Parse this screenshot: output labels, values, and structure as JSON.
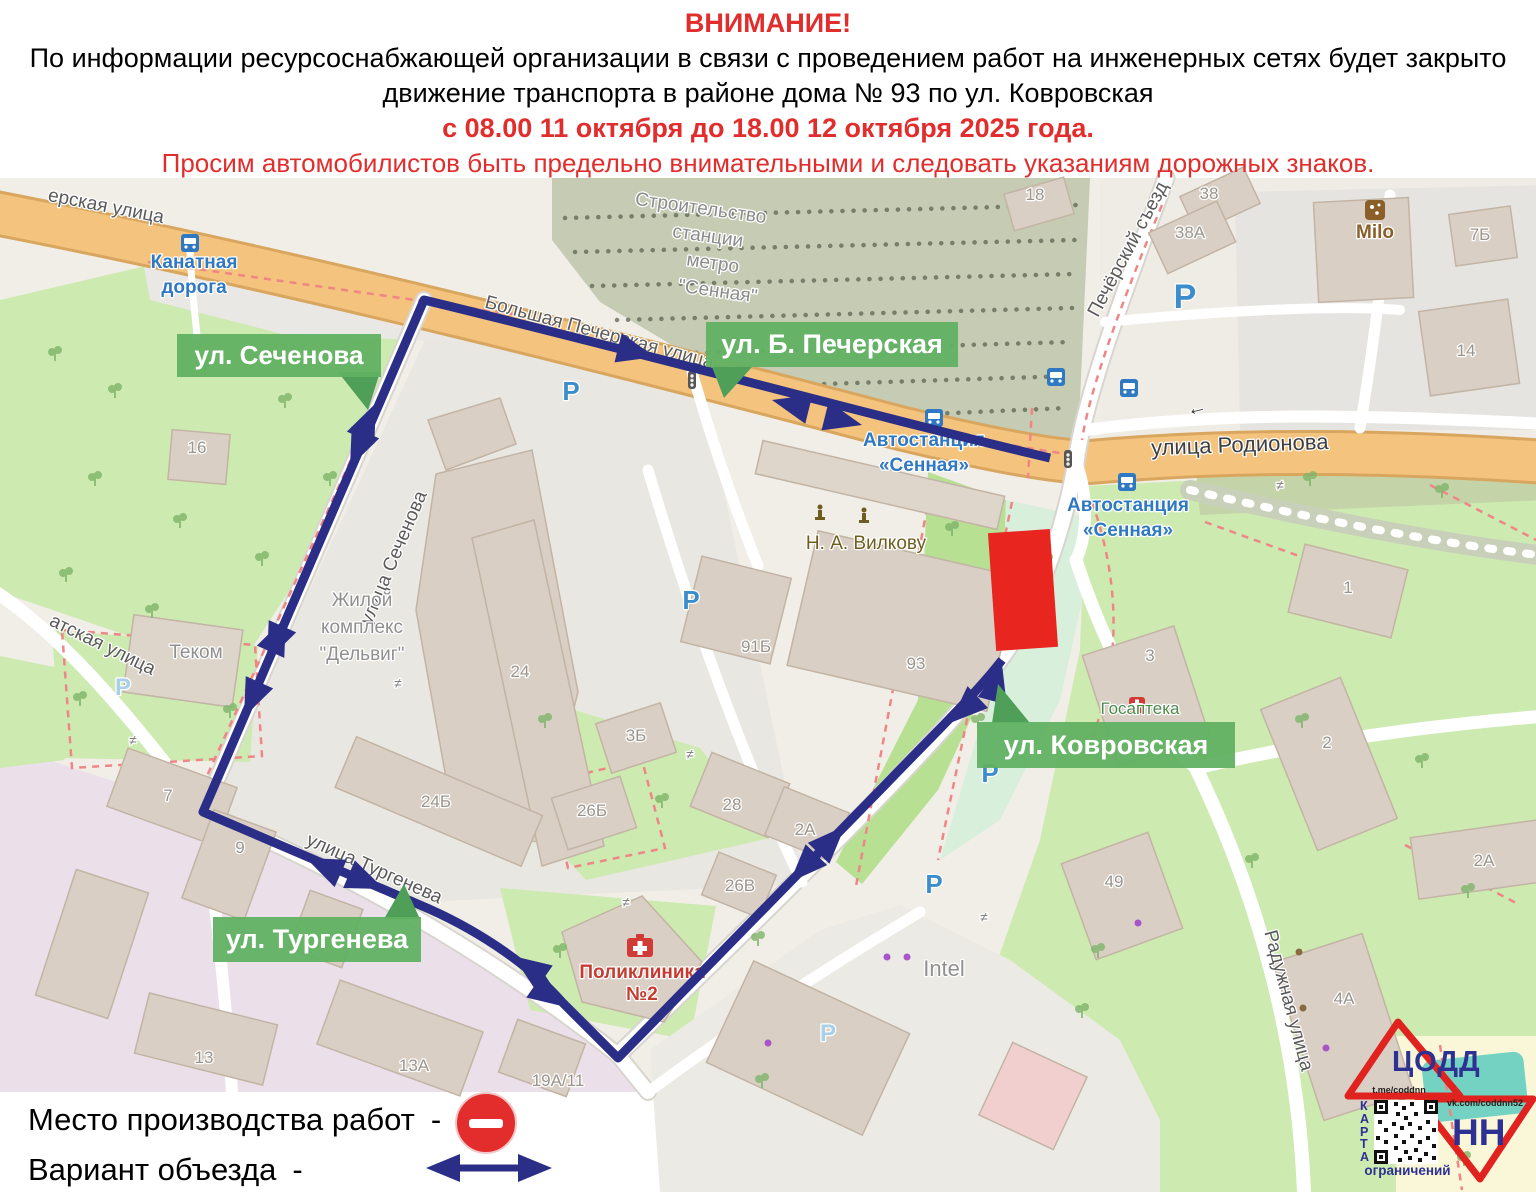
{
  "header": {
    "title": "ВНИМАНИЕ!",
    "line1": "По информации ресурсоснабжающей организации в связи с проведением работ на инженерных сетях будет закрыто",
    "line2": "движение транспорта в районе дома № 93 по ул. Ковровская",
    "dates": "с 08.00 11 октября до 18.00 12 октября 2025 года.",
    "warning": "Просим автомобилистов быть предельно внимательными и следовать указаниям дорожных знаков.",
    "accent_color": "#e22d2d"
  },
  "map": {
    "badges": [
      {
        "label": "ул. Сеченова"
      },
      {
        "label": "ул. Б. Печерская"
      },
      {
        "label": "ул. Ковровская"
      },
      {
        "label": "ул. Тургенева"
      }
    ],
    "badge_color": "#61b163",
    "route_color": "#2b2e87",
    "work_zone_color": "#e8251f",
    "parking_letter": "P",
    "parking": [
      {
        "x": 571,
        "y": 400
      },
      {
        "x": 691,
        "y": 609
      },
      {
        "x": 1185,
        "y": 308,
        "s": "big"
      },
      {
        "x": 990,
        "y": 782
      },
      {
        "x": 934,
        "y": 893
      },
      {
        "x": 828,
        "y": 1041,
        "s": "pale"
      },
      {
        "x": 123,
        "y": 695,
        "s": "pale"
      }
    ],
    "labels": [
      {
        "t": "ерская улица",
        "x": 105,
        "y": 212,
        "r": 11,
        "c": "st"
      },
      {
        "t": "Большая Печерская улица",
        "x": 598,
        "y": 338,
        "r": 15,
        "c": "st"
      },
      {
        "t": "улица Родионова",
        "x": 1240,
        "y": 452,
        "r": -2,
        "c": "stb"
      },
      {
        "t": "Печёрский съезд",
        "x": 1133,
        "y": 252,
        "r": -62,
        "c": "st"
      },
      {
        "t": "улица Сеченова",
        "x": 399,
        "y": 560,
        "r": -67,
        "c": "st"
      },
      {
        "t": "улица Тургенева",
        "x": 372,
        "y": 874,
        "r": 24,
        "c": "st"
      },
      {
        "t": "Радужная улица",
        "x": 1283,
        "y": 1002,
        "r": 75,
        "c": "st"
      },
      {
        "t": "атская улица",
        "x": 100,
        "y": 650,
        "r": 26,
        "c": "st"
      },
      {
        "t": "Канатная",
        "x": 194,
        "y": 268,
        "r": 0,
        "c": "bl"
      },
      {
        "t": "дорога",
        "x": 194,
        "y": 293,
        "r": 0,
        "c": "bl"
      },
      {
        "t": "Автостанция",
        "x": 924,
        "y": 446,
        "r": 0,
        "c": "bl"
      },
      {
        "t": "«Сенная»",
        "x": 924,
        "y": 471,
        "r": 0,
        "c": "bl"
      },
      {
        "t": "Автостанция",
        "x": 1128,
        "y": 511,
        "r": 0,
        "c": "bl"
      },
      {
        "t": "«Сенная»",
        "x": 1128,
        "y": 536,
        "r": 0,
        "c": "bl"
      },
      {
        "t": "Строительство",
        "x": 700,
        "y": 214,
        "r": 8,
        "c": "cn"
      },
      {
        "t": "станции",
        "x": 707,
        "y": 242,
        "r": 8,
        "c": "cn"
      },
      {
        "t": "метро",
        "x": 712,
        "y": 269,
        "r": 8,
        "c": "cn"
      },
      {
        "t": "\"Сенная\"",
        "x": 717,
        "y": 297,
        "r": 8,
        "c": "cn"
      },
      {
        "t": "Жилой",
        "x": 362,
        "y": 606,
        "r": 0,
        "c": "po"
      },
      {
        "t": "комплекс",
        "x": 362,
        "y": 633,
        "r": 0,
        "c": "po"
      },
      {
        "t": "\"Дельвиг\"",
        "x": 362,
        "y": 660,
        "r": 0,
        "c": "po"
      },
      {
        "t": "Теком",
        "x": 196,
        "y": 658,
        "r": 0,
        "c": "po"
      },
      {
        "t": "Intel",
        "x": 944,
        "y": 976,
        "r": 0,
        "c": "pbig"
      },
      {
        "t": "Н. А. Вилкову",
        "x": 866,
        "y": 549,
        "r": 0,
        "c": "br"
      },
      {
        "t": "Milo",
        "x": 1375,
        "y": 238,
        "r": 0,
        "c": "brm"
      },
      {
        "t": "Госаптека",
        "x": 1140,
        "y": 714,
        "r": 0,
        "c": "gr"
      },
      {
        "t": "Поликлиника",
        "x": 642,
        "y": 978,
        "r": 0,
        "c": "rd"
      },
      {
        "t": "№2",
        "x": 642,
        "y": 1000,
        "r": 0,
        "c": "rd"
      },
      {
        "t": "18",
        "x": 1035,
        "y": 200,
        "r": 0,
        "c": "nm"
      },
      {
        "t": "38",
        "x": 1209,
        "y": 199,
        "r": 0,
        "c": "nm"
      },
      {
        "t": "38А",
        "x": 1190,
        "y": 238,
        "r": 0,
        "c": "nm"
      },
      {
        "t": "7Б",
        "x": 1480,
        "y": 240,
        "r": 0,
        "c": "nm"
      },
      {
        "t": "14",
        "x": 1466,
        "y": 356,
        "r": 0,
        "c": "nm"
      },
      {
        "t": "16",
        "x": 197,
        "y": 453,
        "r": 0,
        "c": "nm"
      },
      {
        "t": "24",
        "x": 520,
        "y": 677,
        "r": 0,
        "c": "nm"
      },
      {
        "t": "91Б",
        "x": 756,
        "y": 652,
        "r": 0,
        "c": "nm"
      },
      {
        "t": "93",
        "x": 916,
        "y": 669,
        "r": 0,
        "c": "nm"
      },
      {
        "t": "3Б",
        "x": 636,
        "y": 741,
        "r": 0,
        "c": "nm"
      },
      {
        "t": "26Б",
        "x": 592,
        "y": 816,
        "r": 0,
        "c": "nm"
      },
      {
        "t": "28",
        "x": 732,
        "y": 810,
        "r": 0,
        "c": "nm"
      },
      {
        "t": "2А",
        "x": 805,
        "y": 835,
        "r": 0,
        "c": "nm"
      },
      {
        "t": "26В",
        "x": 740,
        "y": 891,
        "r": 0,
        "c": "nm"
      },
      {
        "t": "24Б",
        "x": 436,
        "y": 807,
        "r": 0,
        "c": "nm"
      },
      {
        "t": "7",
        "x": 168,
        "y": 801,
        "r": 0,
        "c": "nm"
      },
      {
        "t": "9",
        "x": 240,
        "y": 853,
        "r": 0,
        "c": "nm"
      },
      {
        "t": "13",
        "x": 204,
        "y": 1063,
        "r": 0,
        "c": "nm"
      },
      {
        "t": "13А",
        "x": 414,
        "y": 1071,
        "r": 0,
        "c": "nm"
      },
      {
        "t": "19А/11",
        "x": 558,
        "y": 1086,
        "r": 0,
        "c": "nm"
      },
      {
        "t": "49",
        "x": 1114,
        "y": 887,
        "r": 0,
        "c": "nm"
      },
      {
        "t": "1",
        "x": 1348,
        "y": 593,
        "r": 0,
        "c": "nm"
      },
      {
        "t": "3",
        "x": 1150,
        "y": 661,
        "r": 0,
        "c": "nm"
      },
      {
        "t": "2",
        "x": 1327,
        "y": 748,
        "r": 0,
        "c": "nm"
      },
      {
        "t": "2А",
        "x": 1484,
        "y": 866,
        "r": 0,
        "c": "nm"
      },
      {
        "t": "4А",
        "x": 1344,
        "y": 1004,
        "r": 0,
        "c": "nm"
      },
      {
        "t": "←",
        "x": 1198,
        "y": 414,
        "r": -14,
        "c": "ow"
      },
      {
        "t": "≠",
        "x": 398,
        "y": 688,
        "r": 0,
        "c": "gt"
      },
      {
        "t": "≠",
        "x": 133,
        "y": 745,
        "r": 0,
        "c": "gt"
      },
      {
        "t": "≠",
        "x": 626,
        "y": 907,
        "r": 0,
        "c": "gt"
      },
      {
        "t": "≠",
        "x": 690,
        "y": 759,
        "r": 0,
        "c": "gt"
      },
      {
        "t": "≠",
        "x": 984,
        "y": 922,
        "r": 0,
        "c": "gt"
      },
      {
        "t": "≠",
        "x": 1280,
        "y": 490,
        "r": 0,
        "c": "gt"
      }
    ]
  },
  "legend": {
    "work_site_label": "Место производства работ",
    "detour_label": "Вариант объезда",
    "dash": "-",
    "work_site_icon": "no-entry-sign",
    "detour_icon": "two-way-arrow"
  },
  "logo": {
    "org": "ЦОДД",
    "nn": "НН",
    "karta": "КАРТА",
    "restrictions": "ограничений",
    "telegram": "t.me/coddnn",
    "vk": "vk.com/coddnn52",
    "triangle_color": "#e0231f",
    "text_color": "#2d3192"
  }
}
